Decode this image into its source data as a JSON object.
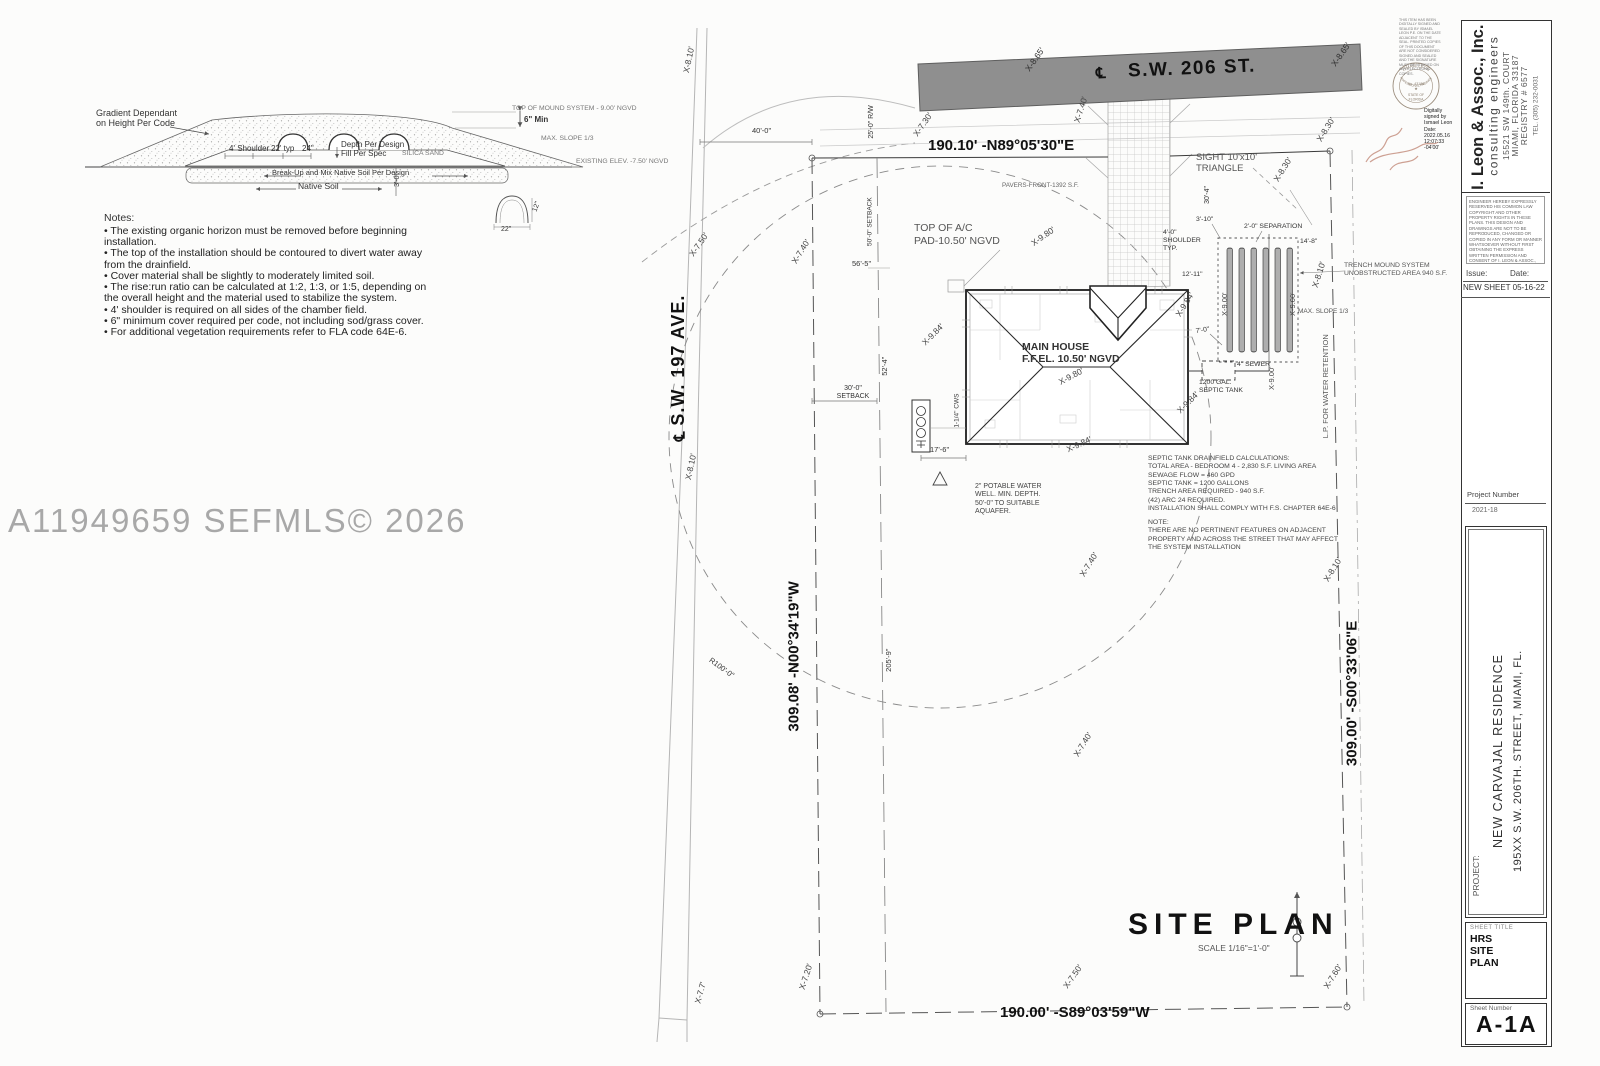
{
  "watermark": "A11949659  SEFMLS© 2026",
  "detail": {
    "gradient_note": "Gradient Dependant\non Height Per Code",
    "top_of_mound": "TOP OF MOUND SYSTEM - 9.00' NGVD",
    "six_min": "6\" Min",
    "max_slope": "MAX. SLOPE 1/3",
    "shoulder": "4' Shoulder",
    "typ_22": "22' typ",
    "dim_24": "24\"",
    "depth_fill": "Depth Per Design\nFill Per Spec",
    "silica_sand": "SILICA SAND",
    "existing_elev": "EXISTING ELEV. -7.50' NGVD",
    "break_up": "Break-Up and Mix Native Soil Per Design",
    "native_soil": "Native Soil",
    "dim_3_0": "3'-0\"",
    "chamber_width": "22\"",
    "chamber_height": "12\"",
    "notes_title": "Notes:",
    "notes": [
      "• The existing organic horizon must be removed before beginning installation.",
      "• The top of the installation should be contoured to divert water away from the drainfield.",
      "• Cover material shall be slightly to moderately limited soil.",
      "• The rise:run ratio can be calculated at 1:2, 1:3, or 1:5, depending on the overall height and the material used to stabilize the system.",
      "• 4' shoulder is required on all sides of the chamber field.",
      "• 6\" minimum cover required per code, not including sod/grass cover.",
      "• For additional vegetation requirements refer to FLA code 64E-6."
    ]
  },
  "site": {
    "street_top": "S.W. 206 ST.",
    "street_left": "S.W. 197 AVE.",
    "centerline_symbol": "℄",
    "bearing_top": "190.10' -N89°05'30\"E",
    "bearing_bottom": "190.00' -S89°03'59\"W",
    "bearing_left": "309.08' -N00°34'19\"W",
    "bearing_right": "309.00' -S00°33'06\"E",
    "title": "SITE PLAN",
    "scale": "SCALE  1/16\"=1'-0\"",
    "main_house": "MAIN HOUSE\nF.F.EL. 10.50' NGVD",
    "ac_pad": "TOP OF A/C\nPAD-10.50' NGVD",
    "pavers": "PAVERS-FRONT-1392 S.F.",
    "sight_triangle": "SIGHT 10'x10'\nTRIANGLE",
    "trench_note": "TRENCH MOUND SYSTEM\nUNOBSTRUCTED AREA 940 S.F.",
    "max_slope": "MAX. SLOPE 1/3",
    "separation": "2'-0\" SEPARATION",
    "shoulder_typ": "4'-0\"\nSHOULDER\nTYP.",
    "sewer": "4\" SEWER",
    "septic_tank": "1200 GAL.\nSEPTIC TANK",
    "lp_retention": "L.P. FOR WATER RETENTION",
    "well_note": "2\" POTABLE WATER\nWELL. MIN. DEPTH.\n50'-0\" TO SUITABLE\nAQUAFER.",
    "calcs": "SEPTIC TANK DRAINFIELD CALCULATIONS:\nTOTAL AREA - BEDROOM 4 - 2,830 S.F. LIVING AREA\nSEWAGE FLOW = 460 GPD\nSEPTIC TANK = 1200 GALLONS\nTRENCH AREA REQUIRED - 940 S.F.\n(42) ARC 24 REQUIRED.\nINSTALLATION SHALL COMPLY WITH F.S. CHAPTER 64E-6",
    "note": "NOTE:\nTHERE ARE NO PERTINENT FEATURES ON ADJACENT\nPROPERTY AND ACROSS THE STREET THAT MAY AFFECT\nTHE SYSTEM INSTALLATION",
    "setback_50": "50'-0\" SETBACK",
    "setback_30": "30'-0\"\nSETBACK",
    "rw_25": "25'-0\" R/W",
    "dims": {
      "d40": "40'-0\"",
      "d56_5": "56'-5\"",
      "d52_4": "52'-4\"",
      "d17_6": "17'-6\"",
      "d205_9": "205'-9\"",
      "d30_4": "30'-4\"",
      "d3_10": "3'-10\"",
      "d14_8": "14'-8\"",
      "d12_11": "12'-11\"",
      "d7_0": "7'-0\"",
      "r100": "R100'-0\"",
      "cws": "1-1/4\" CWS"
    },
    "spots": {
      "e865": "X-8.65'",
      "e830": "X-8.30'",
      "e810": "X-8.10'",
      "e730": "X-7.30'",
      "e740": "X-7.40'",
      "e750": "X-7.50'",
      "e720": "X-7.20'",
      "e760": "X-7.60'",
      "e77": "X-7.7'",
      "e980": "X-9.80'",
      "e984": "X-9.84'",
      "e900": "X-9.00'"
    }
  },
  "titleblock": {
    "company": {
      "name": "I. Leon & Assoc., Inc.",
      "tagline": "consulting engineers",
      "address1": "15521 SW 149th. COURT",
      "address2": "MIAMI, FLORIDA 33187",
      "registry": "REGISTRY # 6577",
      "tel": "TEL. (305) 232-0031"
    },
    "copyright": "ENGINEER HEREBY EXPRESSLY RESERVED HIS COMMON LAW COPYRIGHT AND OTHER PROPERTY RIGHTS IN THESE PLANS. THIS DESIGN AND DRAWINGS ARE NOT TO BE REPRODUCED, CHANGED OR COPIED IN ANY FORM OR MANNER WHATSOEVER WITHOUT FIRST OBTAINING THE EXPRESS WRITTEN PERMISSION AND CONSENT OF I. LEON & ASSOC., INC. NOR ARE THEY TO BE ASSIGNED TO ANY PARTY WITHOUT FIRST OBTAINING SAID WRITTEN PERMISSION AND CONSENT.",
    "issue_label": "Issue:",
    "date_label": "Date:",
    "issue_entry": "NEW SHEET 05-16-22",
    "project_number_label": "Project Number",
    "project_number": "2021-18",
    "project_label": "PROJECT:",
    "project_name": "NEW CARVAJAL RESIDENCE",
    "project_address": "195XX S.W. 206TH. STREET, MIAMI, FL.",
    "sheet_title_label": "SHEET TITLE",
    "sheet_title": "HRS SITE PLAN",
    "sheet_number_label": "Sheet Number",
    "sheet_number": "A-1A",
    "signature": {
      "digital": "Digitally\nsigned by\nIsmael Leon\nDate:\n2022.05.16\n12:07:33\n-04'00'",
      "disclaimer": "THIS ITEM HAS BEEN DIGITALLY SIGNED AND SEALED BY ISMAEL LEON P.E. ON THE DATE ADJACENT TO THE SEAL. PRINTED COPIES OF THIS DOCUMENT ARE NOT CONSIDERED SIGNED AND SEALED AND THE SIGNATURE MUST BE VERIFIED ON ANY ELECTRONIC COPIES."
    },
    "seal": {
      "arc_top": "ISMAEL LEON",
      "arc_bottom": "PROFESSIONAL ENGINEER",
      "no": "No. 43188",
      "state": "STATE OF",
      "state2": "FLORIDA"
    }
  }
}
